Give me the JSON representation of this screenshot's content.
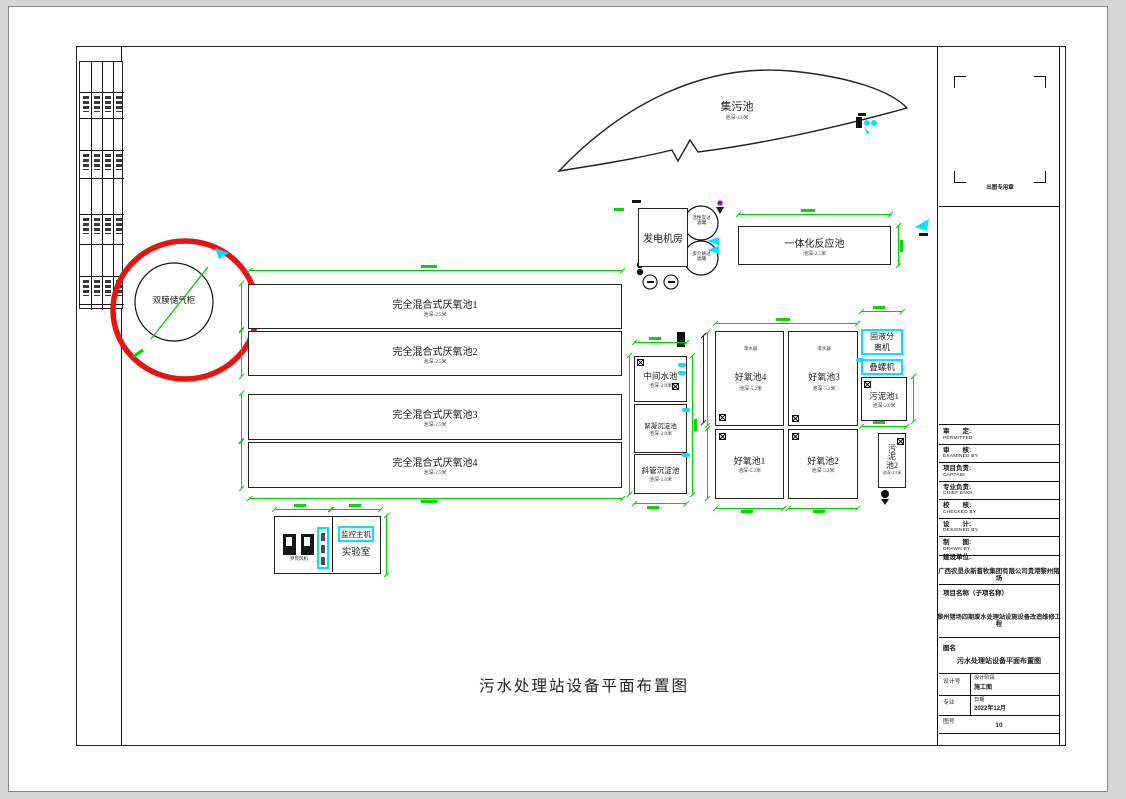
{
  "page": {
    "main_title": "污水处理站设备平面布置图"
  },
  "pools": {
    "collection": {
      "name": "集污池",
      "depth": "池深-4.0米"
    },
    "generator_room": {
      "name": "发电机房"
    },
    "integrated": {
      "name": "一体化反应池",
      "depth": "池深-2.5米"
    },
    "carbon_filter": {
      "name": "活性炭过\n滤罐"
    },
    "media_filter": {
      "name": "多介质过\n滤罐"
    },
    "gas_holder": {
      "name": "双膜储气柜"
    },
    "anaerobic": [
      {
        "name": "完全混合式厌氧池1",
        "depth": "池深-2.5米"
      },
      {
        "name": "完全混合式厌氧池2",
        "depth": "池深-2.5米"
      },
      {
        "name": "完全混合式厌氧池3",
        "depth": "池深-2.5米"
      },
      {
        "name": "完全混合式厌氧池4",
        "depth": "池深-2.5米"
      }
    ],
    "middle": {
      "name": "中间水池",
      "depth": "池深-2.0米"
    },
    "flocculation": {
      "name": "絮凝沉淀池",
      "depth": "池深-2.0米"
    },
    "inclined": {
      "name": "斜管沉淀池",
      "depth": "池深-2.0米"
    },
    "aerobic4": {
      "name": "好氧池4",
      "depth": "池深-5.2米"
    },
    "aerobic3": {
      "name": "好氧池3",
      "depth": "池深-5.2米"
    },
    "aerobic1": {
      "name": "好氧池1",
      "depth": "池深-5.2米"
    },
    "aerobic2": {
      "name": "好氧池2",
      "depth": "池深-5.2米"
    },
    "decanter": "滗水器",
    "separator": {
      "name": "固液分\n离机"
    },
    "screw_press": {
      "name": "叠螺机"
    },
    "sludge1": {
      "name": "污泥池1",
      "depth": "池深-2.0米"
    },
    "sludge2": {
      "name": "污\n泥\n池2",
      "depth": "池深-2.5米"
    },
    "monitor": {
      "name": "监控主机"
    },
    "lab": {
      "name": "实验室"
    },
    "blowers": {
      "name": "罗茨风机"
    }
  },
  "titleblock": {
    "stamp_caption": "出图专用章",
    "rows": [
      {
        "cn": "审　　定:",
        "en": "PERMITTED"
      },
      {
        "cn": "审　　核:",
        "en": "EXAMINED BY"
      },
      {
        "cn": "项目负责:",
        "en": "CAPTAIN"
      },
      {
        "cn": "专业负责:",
        "en": "CHIEF ENGI."
      },
      {
        "cn": "校　　核:",
        "en": "CHECKED BY"
      },
      {
        "cn": "设　　计:",
        "en": "DESIGNED BY"
      },
      {
        "cn": "制　　图:",
        "en": "DRAWN BY"
      }
    ],
    "owner_label": "建设单位:",
    "owner": "广西农垦永新畜牧集团有限公司贵港黎州猪场",
    "project_label": "项目名称（子项名称）",
    "project": "黎州猪场四期废水处理站设施设备改造维修工程",
    "drawing_label": "图名",
    "drawing_name": "污水处理站设备平面布置图",
    "design_no_label": "设计号",
    "stage_label": "设计阶段",
    "stage": "施工图",
    "discipline_label": "专业",
    "date_label": "日期",
    "date": "2022年12月",
    "sheet_label": "图号",
    "sheet": "10"
  },
  "colors": {
    "dim_green": "#00d200",
    "highlight_cyan": "#00e4ff",
    "mark_red": "#e81212"
  }
}
